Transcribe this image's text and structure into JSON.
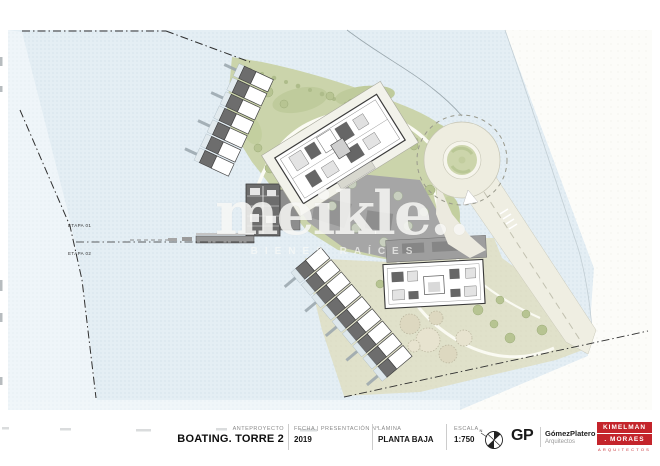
{
  "plan": {
    "etapa1_label": "ETAPA 01",
    "etapa2_label": "ETAPA 02"
  },
  "watermark": {
    "brand": "meikle..",
    "subtitle": "BIENES RAÍCES"
  },
  "titleblock": {
    "project_type_label": "ANTEPROYECTO",
    "project_name": "BOATING. TORRE 2",
    "date_label": "FECHA | PRESENTACIÓN N°",
    "date_value": "2019",
    "sheet_label": "LÁMINA",
    "sheet_value": "PLANTA BAJA",
    "scale_label": "ESCALA",
    "scale_value": "1:750",
    "firm1_initials": "GP",
    "firm1_name": "GómezPlatero",
    "firm1_subtitle": "Arquitectos",
    "firm2_line1": "KIMELMAN",
    "firm2_line2": ". MORAES",
    "firm2_subtitle": "ARQUITECTOS"
  },
  "colors": {
    "water": "#e4eef4",
    "green": "#cbd4ab",
    "plaza": "#a6a6a6",
    "building_dark": "#6d6d6d",
    "road": "#efeee2",
    "accent_red": "#c4242b"
  }
}
